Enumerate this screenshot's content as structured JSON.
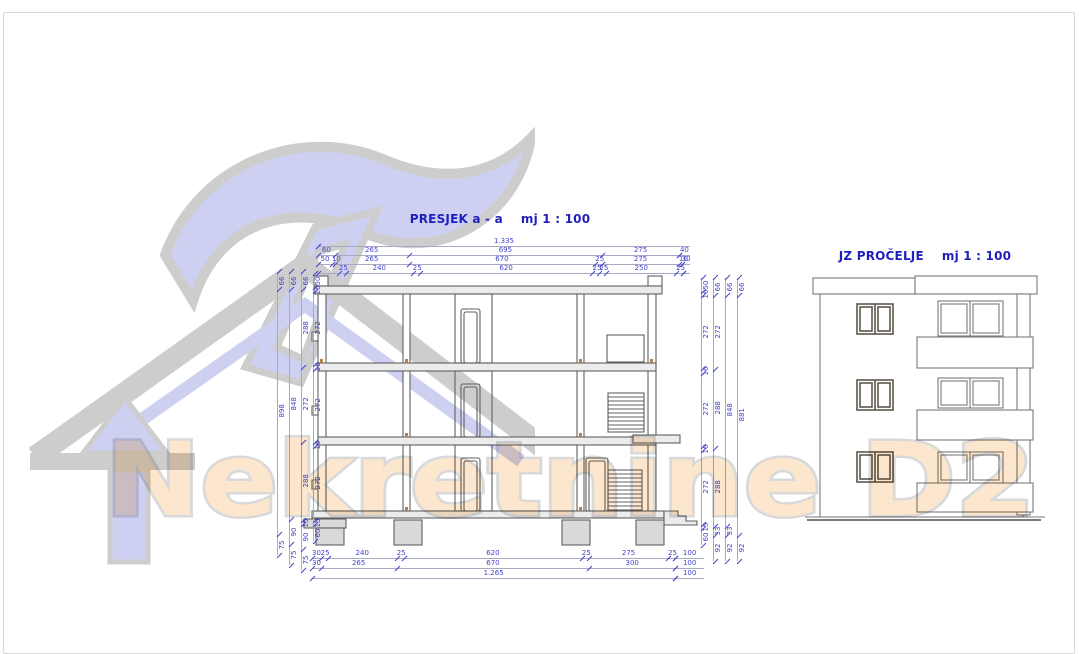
{
  "page": {
    "background": "#ffffff",
    "frame_border_color": "#d7d7d7"
  },
  "watermark": {
    "text": "Nekretnine D2",
    "text_fill": "#fbd8af",
    "text_outline": "#c2c2c2",
    "logo_fill": "#c9cbf0",
    "logo_outline": "#c8c8c8"
  },
  "colors": {
    "title_blue": "#1f1fbe",
    "dimension_blue": "#4444cc",
    "drawing_line": "#606060",
    "fill_light_gray": "#d9d9d9"
  },
  "section": {
    "title": "PRESJEK a - a",
    "scale_label": "mj 1 : 100",
    "dims_top": {
      "rows": [
        [
          "1.335"
        ],
        [
          "60",
          "265",
          "695",
          "275",
          "40"
        ],
        [
          "50",
          "10",
          "265",
          "670",
          "25",
          "275",
          "10",
          "30"
        ],
        [
          "25",
          "240",
          "25",
          "620",
          "25",
          "25",
          "250",
          "25"
        ]
      ]
    },
    "dims_bottom": {
      "rows": [
        [
          "30",
          "25",
          "240",
          "25",
          "620",
          "25",
          "275",
          "25",
          "100"
        ],
        [
          "30",
          "265",
          "670",
          "300",
          "100"
        ],
        [
          "1.265",
          "100"
        ]
      ]
    },
    "dims_left": {
      "chains": [
        [
          "66",
          "898",
          "75"
        ],
        [
          "66",
          "848",
          "90",
          "75"
        ],
        [
          "66",
          "288",
          "272",
          "288",
          "15",
          "90",
          "75"
        ],
        [
          "50",
          "16",
          "272",
          "16",
          "272",
          "16",
          "272",
          "15",
          "60"
        ]
      ]
    },
    "dims_right": {
      "chains": [
        [
          "50",
          "16",
          "272",
          "16",
          "272",
          "16",
          "272",
          "15",
          "60"
        ],
        [
          "66",
          "272",
          "288",
          "288",
          "33",
          "92"
        ],
        [
          "66",
          "848",
          "33",
          "92"
        ],
        [
          "66",
          "881",
          "92"
        ]
      ]
    }
  },
  "facade": {
    "title": "JZ PROČELJE",
    "scale_label": "mj 1 : 100"
  }
}
